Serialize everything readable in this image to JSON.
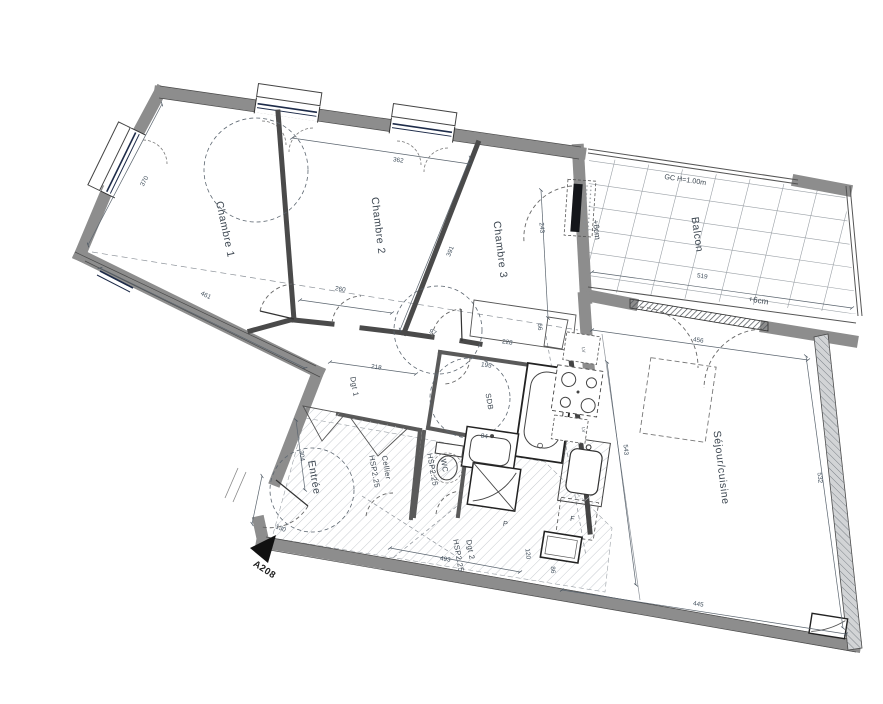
{
  "plan": {
    "unit": "A208",
    "rooms": {
      "chambre1": "Chambre 1",
      "chambre2": "Chambre 2",
      "chambre3": "Chambre 3",
      "balcon": "Balcon",
      "sejour": "Séjour/cuisine",
      "entree": "Entrée",
      "cellier": "Cellier",
      "wc": "WC",
      "sdb": "SDB",
      "dgt1": "Dgt 1",
      "dgt2": "Dgt 2"
    },
    "annotations": {
      "hsp": "HSP2.25",
      "gc": "GC H=1.00m",
      "plus6": "+6cm",
      "fridge": "F",
      "palier": "P",
      "appliance": "LV"
    },
    "dimensions": {
      "left_wall": "370",
      "ch1_bottom": "461",
      "ch2_top": "362",
      "ch2_bottom": "260",
      "ch2_ch3_wall": "391",
      "ch3_right": "243",
      "ch3_placard_w": "228",
      "ch3_placard_h": "66",
      "hall_97": "97",
      "dgt1_len": "218",
      "sdb_195": "195",
      "sdb_84": "84",
      "entree_h": "304",
      "entree_door": "130",
      "sejour_top": "456",
      "sejour_right": "532",
      "kitchen_543": "543",
      "sejour_bottom": "445",
      "balcon_len": "519",
      "dgt2_len": "493",
      "k_120": "120",
      "k_86": "86"
    }
  }
}
